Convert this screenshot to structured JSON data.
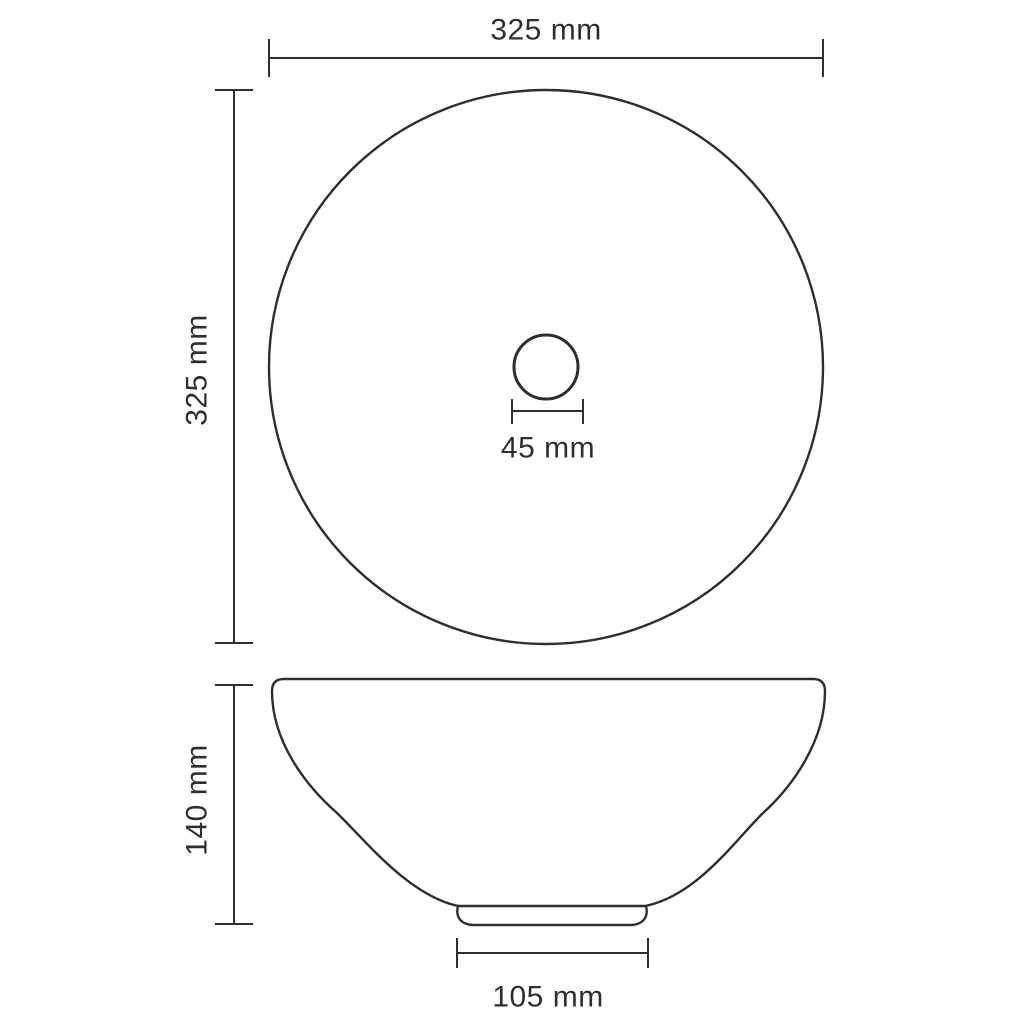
{
  "drawing": {
    "unit": "mm",
    "ink_color": "#2e2e2e",
    "background_color": "#ffffff",
    "dimensions": {
      "top_width": {
        "label": "325 mm",
        "value": 325
      },
      "left_height": {
        "label": "325 mm",
        "value": 325
      },
      "drain_width": {
        "label": "45 mm",
        "value": 45
      },
      "side_height": {
        "label": "140 mm",
        "value": 140
      },
      "base_width": {
        "label": "105 mm",
        "value": 105
      }
    }
  }
}
